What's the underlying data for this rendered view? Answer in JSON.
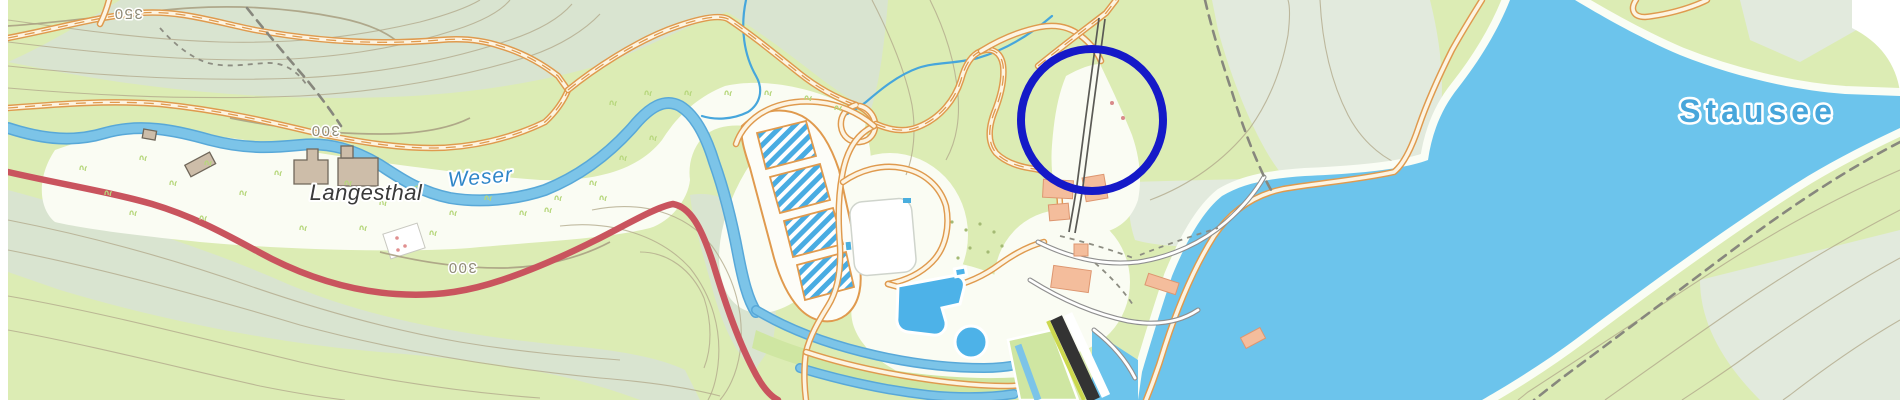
{
  "map": {
    "type": "topographic-map",
    "labels": {
      "settlement": "Langesthal",
      "river": "Weser",
      "lake": "Stausee",
      "contours": [
        "350",
        "300",
        "300"
      ]
    },
    "annotation": {
      "shape": "circle",
      "color": "#1519c8"
    },
    "colors": {
      "base_green": "#dcecb4",
      "forest_green": "#d9e4d0",
      "meadow_white": "#fafcf3",
      "lake_blue": "#6cc4ec",
      "river_blue": "#7cc4e8",
      "stream_blue": "#46a6dc",
      "road_orange": "#df9a4e",
      "road_red": "#c9545e",
      "road_gray": "#8f8f8f",
      "contour_brown": "#b3aa8c",
      "building_tan": "#cdbda9",
      "building_salmon": "#f4bd9c",
      "dam_dark": "#333333",
      "dam_road_green": "#ccd84e",
      "parking_hatch_blue": "#49ace2",
      "label_town": "#3a3a3a",
      "label_river": "#2f86c8",
      "label_lake": "#47a6db"
    }
  }
}
